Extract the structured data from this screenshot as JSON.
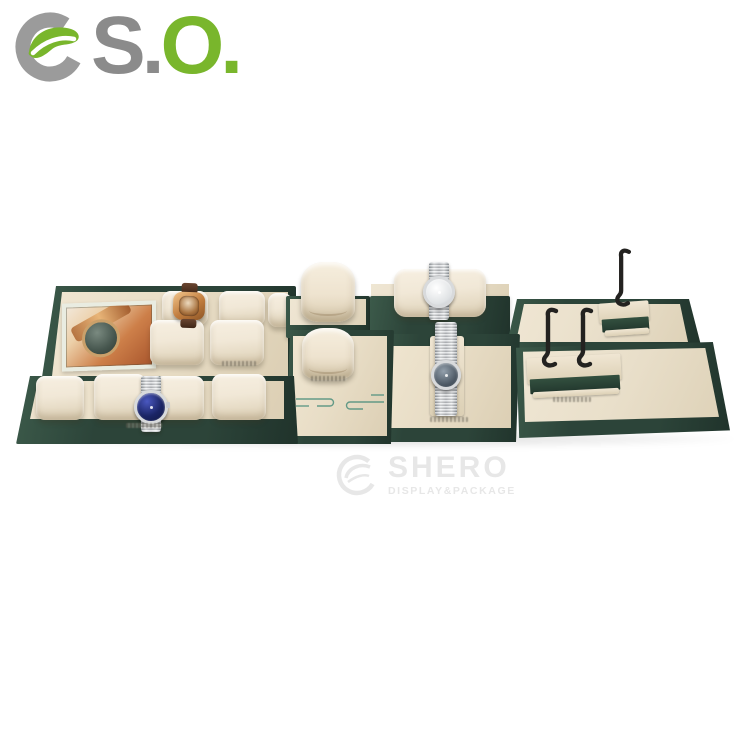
{
  "page": {
    "background": "#ffffff"
  },
  "logo": {
    "text_gray": "S.",
    "text_green": "O.",
    "color_gray": "#8b8b8b",
    "color_green": "#79b62c",
    "icon": "swirl-ring-icon"
  },
  "watermark": {
    "title": "SHERO",
    "subtitle": "DISPLAY&PACKAGE",
    "color": "#e7e7e7",
    "icon": "ring-logo-icon"
  },
  "product": {
    "alt": "Watch display prop set in dark green and champagne leather: tiered pillow trays with framed watch photo, pillow stands, riser block, bracelet ramp and black metal hook stands, showing four watches.",
    "colors": {
      "leather_green": "#2c4439",
      "leather_green_dark": "#20332b",
      "leather_green_light": "#3c5a4a",
      "deck_beige": "#e8ddc6",
      "pillow_cream": "#f1e8d7",
      "pillow_shadow": "#dbceb3",
      "hook_black": "#232220",
      "meander_teal": "#4d8f7d",
      "stamp_gray": "#8e897d"
    },
    "watches": [
      {
        "position": "left upper tray pillow",
        "style": "rose-gold tonneau case with brown leather strap",
        "dial_color": "#7a4a26"
      },
      {
        "position": "left lower tray pillow",
        "style": "steel bracelet chronograph",
        "dial_color": "#1b2566"
      },
      {
        "position": "center riser block pillow",
        "style": "steel bracelet watch, silver dial",
        "dial_color": "#dfe2e4"
      },
      {
        "position": "center bracelet ramp",
        "style": "steel bracelet watch, grey dial",
        "dial_color": "#4e5a66"
      }
    ],
    "components": [
      "two-tier pillow tray with photo frame",
      "watch pillows",
      "pillow stand console with meander embroidery",
      "riser block with watch pillow",
      "bracelet display ramp",
      "single-hook stand tray",
      "double-hook stand tray",
      "embossed brand stamps"
    ]
  }
}
